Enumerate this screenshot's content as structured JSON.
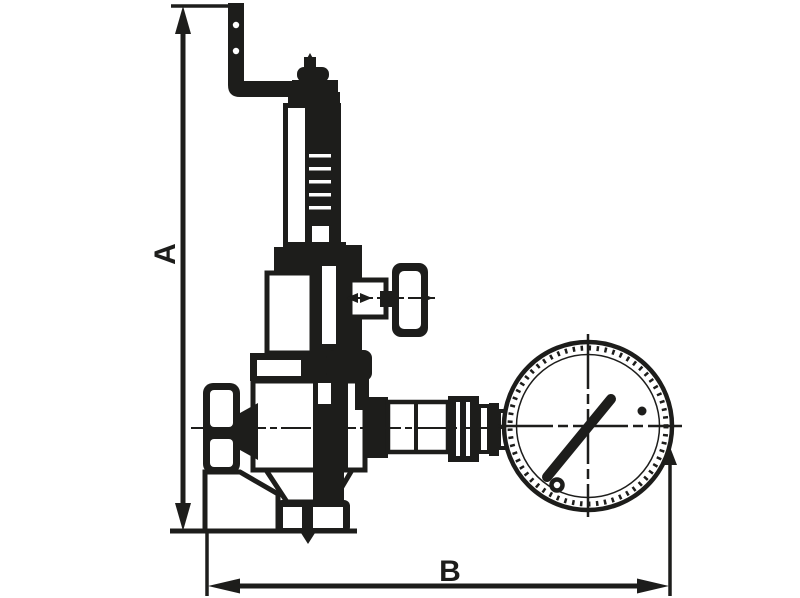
{
  "diagram": {
    "background_color": "#ffffff",
    "ink_color": "#1d1d1b",
    "dimension_labels": {
      "vertical": "A",
      "horizontal": "B"
    }
  }
}
